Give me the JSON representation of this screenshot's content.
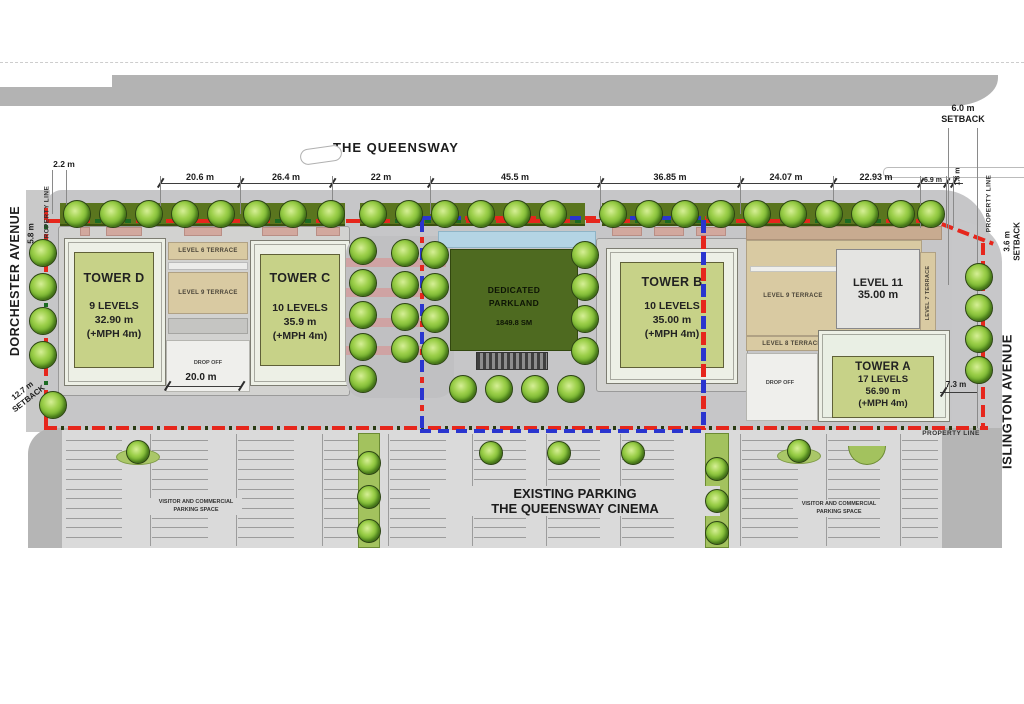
{
  "streets": {
    "queensway": "THE QUEENSWAY",
    "dorchester": "DORCHESTER AVENUE",
    "islington": "ISLINGTON AVENUE"
  },
  "top_dimensions": [
    "20.6 m",
    "26.4 m",
    "22 m",
    "45.5 m",
    "36.85 m",
    "24.07 m",
    "22.93 m",
    "6.9 m",
    "1.8 m"
  ],
  "setbacks": {
    "north": "6.0 m",
    "east": "3.6 m",
    "west": "12.7 m",
    "setback_word": "SETBACK"
  },
  "measurements": {
    "property_gap": "2.2 m",
    "dorchester_width": "5.8 m",
    "drop_off_width": "20.0 m",
    "tower_a_side": "7.3 m"
  },
  "labels": {
    "property_line": "PROPERTY LINE",
    "drop_off": "DROP OFF"
  },
  "towers": {
    "d": {
      "name": "TOWER D",
      "levels": "9 LEVELS",
      "height": "32.90 m",
      "mph": "(+MPH 4m)"
    },
    "c": {
      "name": "TOWER C",
      "levels": "10 LEVELS",
      "height": "35.9 m",
      "mph": "(+MPH 4m)"
    },
    "b": {
      "name": "TOWER B",
      "levels": "10 LEVELS",
      "height": "35.00 m",
      "mph": "(+MPH 4m)"
    },
    "a": {
      "name": "TOWER A",
      "levels": "17 LEVELS",
      "height": "56.90 m",
      "mph": "(+MPH 4m)"
    }
  },
  "level11": {
    "name": "LEVEL 11",
    "height": "35.00 m"
  },
  "terraces": {
    "level6": "LEVEL 6 TERRACE",
    "level9": "LEVEL 9 TERRACE",
    "level8": "LEVEL 8 TERRACE",
    "level7": "LEVEL 7 TERRACE"
  },
  "parkland": {
    "line1": "DEDICATED",
    "line2": "PARKLAND",
    "area": "1849.8 SM"
  },
  "parking": {
    "title1": "EXISTING PARKING",
    "title2": "THE QUEENSWAY CINEMA",
    "visitor1": "VISITOR AND COMMERCIAL",
    "visitor2": "PARKING SPACE"
  }
}
